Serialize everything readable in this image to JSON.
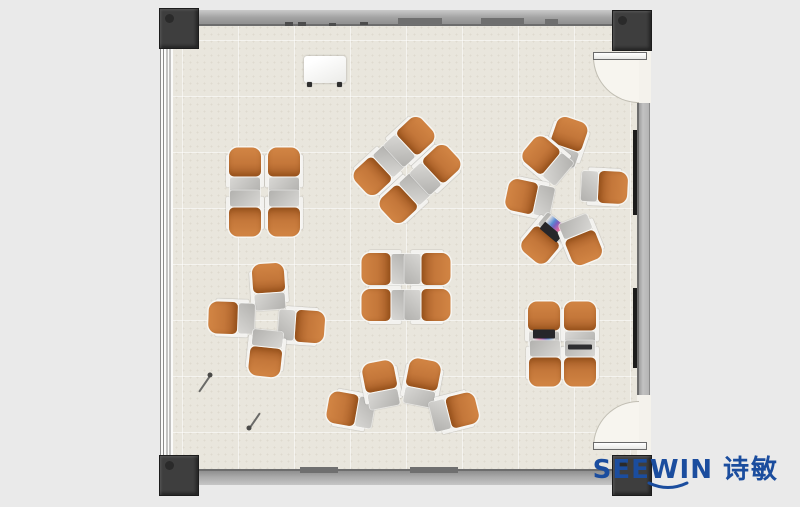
{
  "canvas": {
    "width": 800,
    "height": 507,
    "background": "#eaeaea"
  },
  "logo": {
    "brand": "SEEWIN",
    "cjk": "诗敏",
    "color": "#1b4d9e"
  },
  "palette": {
    "floor": "#e9e6dd",
    "wall": "#a8a8a8",
    "column": "#3e3e3e",
    "chair_seat_orange": "#c4773a",
    "chair_tablet_gray": "#c6c5c2",
    "door_swing": "#f7f5ef",
    "logo_blue": "#1b4d9e"
  },
  "floorplan": {
    "clusters": [
      {
        "name": "cluster-top-left",
        "chairs": [
          {
            "x": 245,
            "y": 171,
            "rot": 0
          },
          {
            "x": 284,
            "y": 171,
            "rot": 0
          },
          {
            "x": 245,
            "y": 213,
            "rot": 180
          },
          {
            "x": 284,
            "y": 213,
            "rot": 180
          }
        ]
      },
      {
        "name": "cluster-top-middle",
        "chairs": [
          {
            "x": 378,
            "y": 171,
            "rot": 227
          },
          {
            "x": 410,
            "y": 141,
            "rot": 47
          },
          {
            "x": 404,
            "y": 199,
            "rot": 227
          },
          {
            "x": 436,
            "y": 169,
            "rot": 47
          }
        ]
      },
      {
        "name": "cluster-circle",
        "chairs": [
          {
            "x": 567,
            "y": 142,
            "rot": 19
          },
          {
            "x": 547,
            "y": 160,
            "rot": 310
          },
          {
            "x": 530,
            "y": 198,
            "rot": 282
          },
          {
            "x": 604,
            "y": 187,
            "rot": 93
          },
          {
            "x": 545,
            "y": 239,
            "rot": 220,
            "acc": "laptop-open"
          },
          {
            "x": 581,
            "y": 240,
            "rot": 158
          }
        ]
      },
      {
        "name": "cluster-mid-left",
        "chairs": [
          {
            "x": 269,
            "y": 287,
            "rot": 356
          },
          {
            "x": 232,
            "y": 318,
            "rot": 272
          },
          {
            "x": 301,
            "y": 326,
            "rot": 94
          },
          {
            "x": 266,
            "y": 353,
            "rot": 186
          }
        ]
      },
      {
        "name": "cluster-center",
        "chairs": [
          {
            "x": 385,
            "y": 269,
            "rot": 270
          },
          {
            "x": 427,
            "y": 269,
            "rot": 90
          },
          {
            "x": 385,
            "y": 305,
            "rot": 270
          },
          {
            "x": 427,
            "y": 305,
            "rot": 90
          }
        ]
      },
      {
        "name": "cluster-fan",
        "chairs": [
          {
            "x": 351,
            "y": 410,
            "rot": 280
          },
          {
            "x": 381,
            "y": 385,
            "rot": 349
          },
          {
            "x": 422,
            "y": 383,
            "rot": 11
          },
          {
            "x": 454,
            "y": 412,
            "rot": 76
          }
        ]
      },
      {
        "name": "cluster-right",
        "chairs": [
          {
            "x": 544,
            "y": 325,
            "rot": 0,
            "acc": "laptop-open"
          },
          {
            "x": 580,
            "y": 325,
            "rot": 0
          },
          {
            "x": 545,
            "y": 363,
            "rot": 180
          },
          {
            "x": 580,
            "y": 363,
            "rot": 180,
            "acc": "laptop-closed"
          }
        ]
      }
    ],
    "whiteboard": {
      "x": 304,
      "y": 56,
      "w": 42,
      "h": 27
    },
    "sticks": [
      {
        "x1": 199,
        "y1": 391,
        "x2": 210,
        "y2": 375
      },
      {
        "x1": 260,
        "y1": 412,
        "x2": 249,
        "y2": 428
      }
    ],
    "wall_marks": {
      "top_bands": [
        [
          398,
          18,
          44,
          7
        ],
        [
          481,
          18,
          43,
          7
        ],
        [
          545,
          19,
          13,
          5
        ]
      ],
      "top_ticks": [
        [
          285,
          22,
          8,
          4
        ],
        [
          298,
          22,
          8,
          4
        ],
        [
          329,
          23,
          7,
          3
        ],
        [
          360,
          22,
          8,
          3
        ]
      ],
      "bottom_bands": [
        [
          300,
          467,
          38,
          6
        ],
        [
          410,
          467,
          48,
          6
        ]
      ],
      "right_strips": [
        [
          633,
          130,
          4,
          85
        ],
        [
          633,
          288,
          4,
          80
        ]
      ]
    }
  }
}
